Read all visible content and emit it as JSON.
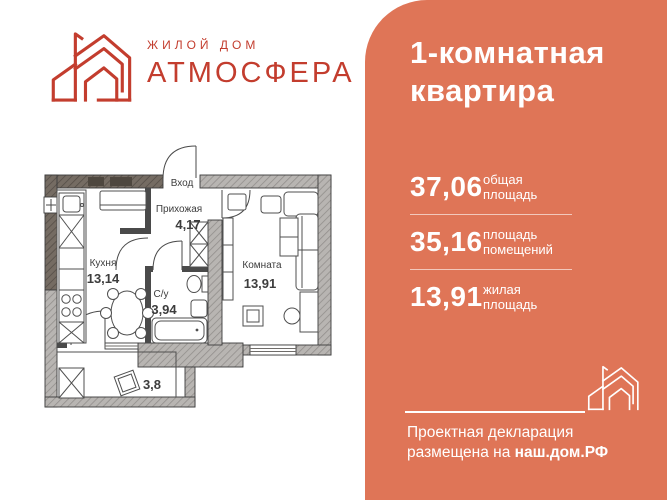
{
  "brand": {
    "tagline": "ЖИЛОЙ ДОМ",
    "name": "АТМОСФЕРА"
  },
  "panel": {
    "title_line1": "1-комнатная",
    "title_line2": "квартира",
    "stats": [
      {
        "value": "37,06",
        "label_line1": "общая",
        "label_line2": "площадь"
      },
      {
        "value": "35,16",
        "label_line1": "площадь",
        "label_line2": "помещений"
      },
      {
        "value": "13,91",
        "label_line1": "жилая",
        "label_line2": "площадь"
      }
    ],
    "footer_line1": "Проектная декларация",
    "footer_line2_prefix": "размещена на ",
    "footer_line2_bold": "наш.дом.РФ"
  },
  "floorplan": {
    "entrance_label": "Вход",
    "hallway": {
      "name": "Прихожая",
      "area": "4,17"
    },
    "kitchen": {
      "name": "Кухня",
      "area": "13,14"
    },
    "bathroom": {
      "name": "С/у",
      "area": "3,94"
    },
    "room": {
      "name": "Комната",
      "area": "13,91"
    },
    "balcony": {
      "area": "3,8"
    }
  },
  "colors": {
    "panel_orange": "#df7557",
    "brand_red": "#c33d2e",
    "wall_light": "#b8b5b2",
    "wall_dark": "#756c63",
    "plan_text": "#3d3d3d",
    "panel_text": "#ffffff"
  }
}
